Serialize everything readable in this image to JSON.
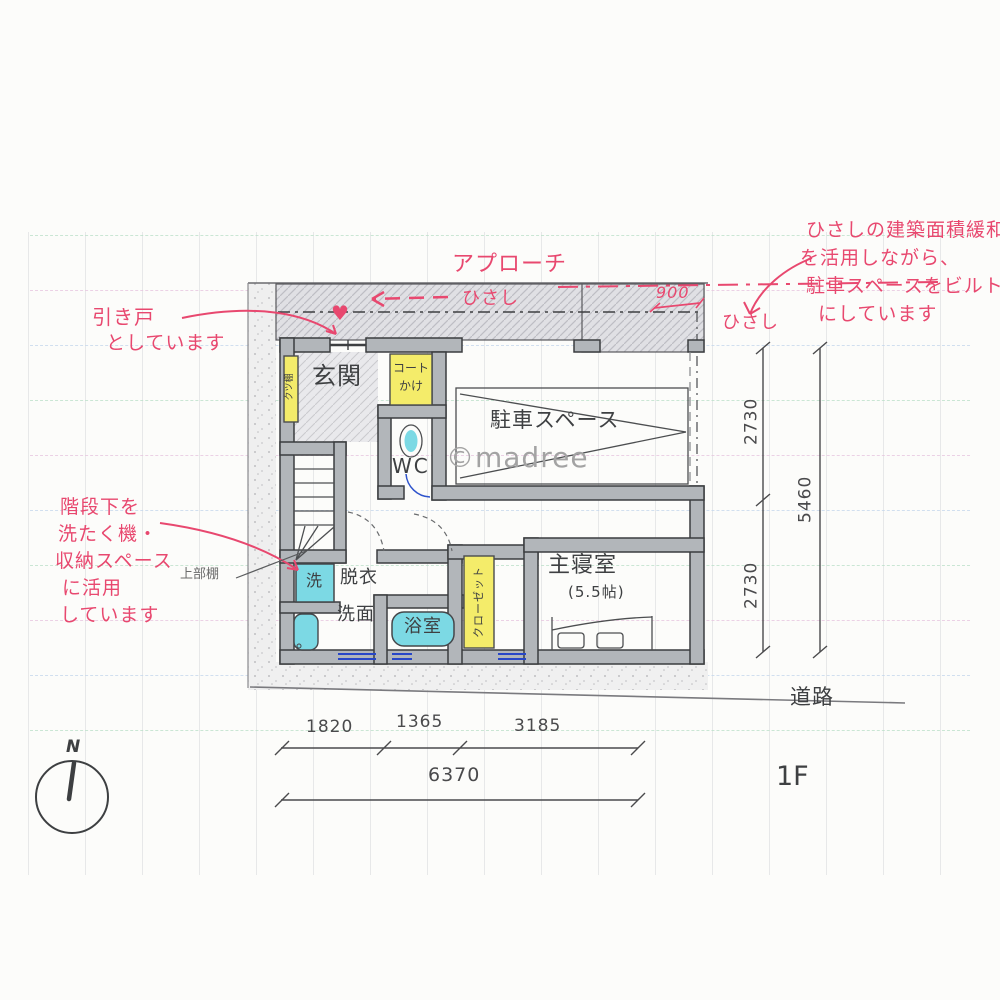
{
  "watermark": "©madree",
  "floor_label": "1F",
  "road_label": "道路",
  "compass": {
    "north": "N"
  },
  "icons": {
    "door_marker": "♥"
  },
  "notes": {
    "approach": "アプローチ",
    "eaves_top": "ひさし",
    "eaves_right": "ひさし",
    "eaves_depth": "900",
    "sliding_door": {
      "line1": "引き戸",
      "line2": "としています"
    },
    "eaves_note": {
      "line1": "ひさしの建築面積緩和",
      "line2": "を活用しながら、",
      "line3": "駐車スペースをビルトイン",
      "line4": "にしています"
    },
    "stairs_note": {
      "line1": "階段下を",
      "line2": "洗たく機・",
      "line3": "収納スペース",
      "line4": "に活用",
      "line5": "しています"
    }
  },
  "rooms": {
    "entrance": "玄関",
    "coat_rack_line1": "コート",
    "coat_rack_line2": "かけ",
    "toilet": "WC",
    "parking": "駐車スペース",
    "master_bedroom": "主寝室",
    "master_bedroom_size": "(5.5帖)",
    "closet": "クローゼット",
    "dressing": "脱衣",
    "washroom": "洗面",
    "bathroom": "浴室",
    "washer": "洗",
    "upper_shelf": "上部棚",
    "shoe_shelf": "クツ棚"
  },
  "dimensions": {
    "right_top": "2730",
    "right_bottom": "2730",
    "right_total": "5460",
    "bottom_1": "1820",
    "bottom_2": "1365",
    "bottom_3": "3185",
    "bottom_total": "6370"
  },
  "colors": {
    "annotation_pink": "#e8486f",
    "highlight_yellow": "#f4ec6a",
    "highlight_cyan": "#7cd9e4",
    "wall_gray": "#b2b6ba",
    "ink": "#3d3f41",
    "watermark_gray": "#a3a3a3"
  }
}
